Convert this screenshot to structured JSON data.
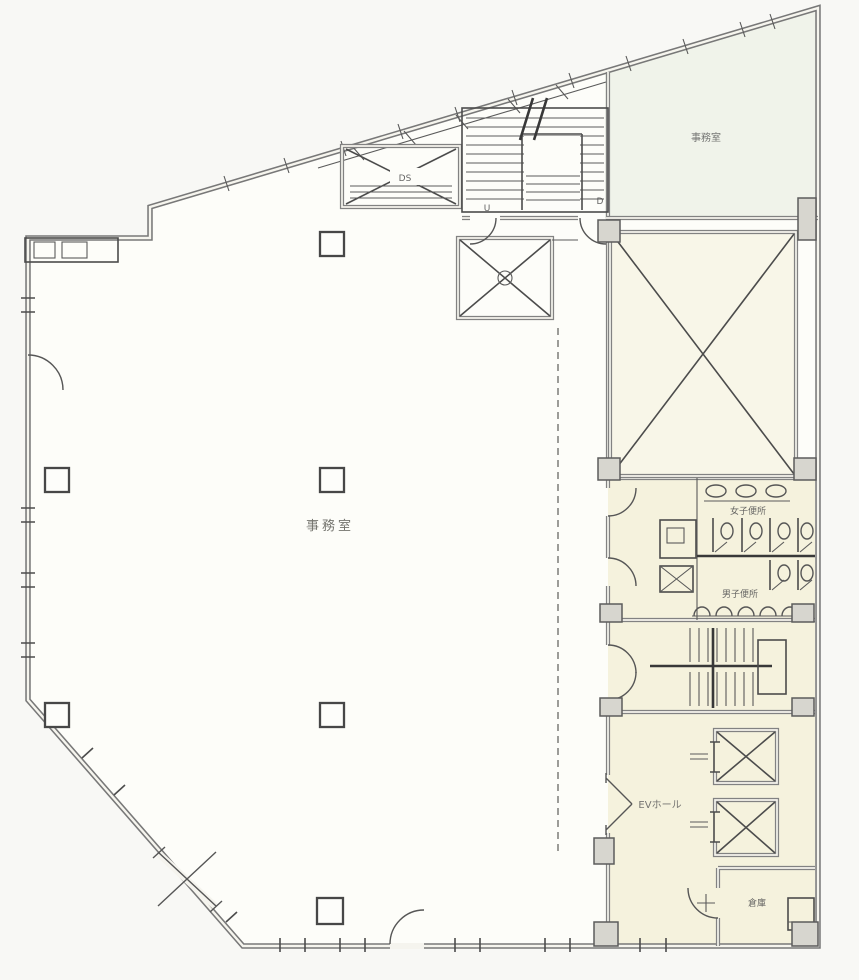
{
  "plan": {
    "rooms": {
      "main_office": "事務室",
      "upper_office": "事務室",
      "womens_toilet": "女子便所",
      "mens_toilet": "男子便所",
      "elevator_hall": "EVホール",
      "storage": "倉庫",
      "duct_space": "DS"
    },
    "stairs": {
      "up_mark": "U",
      "down_mark": "D"
    },
    "colors": {
      "paper": "#f8f8f5",
      "floor": "#fdfdf9",
      "core_floor": "#f5f2dd",
      "shaft_floor": "#f8f6e8",
      "upper_office_floor": "#f0f3ea",
      "wall_gray": "#787878",
      "line_dark": "#4c4c4c"
    }
  }
}
